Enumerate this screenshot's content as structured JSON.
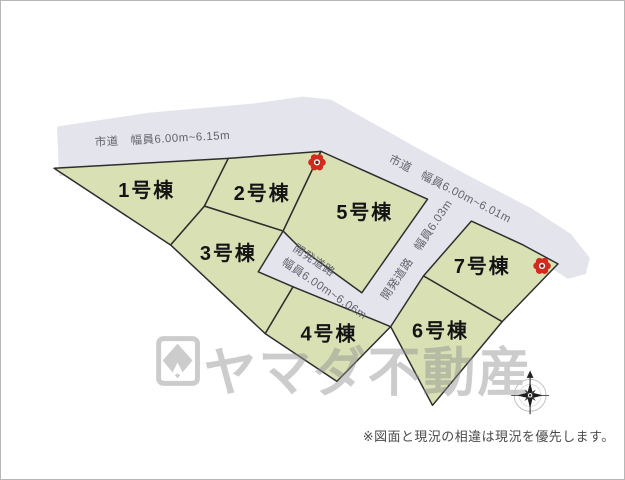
{
  "map": {
    "roads": {
      "shidou_top_label": "市道　幅員6.00m~6.15m",
      "shidou_right_label": "市道　幅員6.00m~6.01m",
      "kaihatsu_main_label_line1": "開発道路",
      "kaihatsu_main_label_line2": "幅員6.00m~6.06m",
      "kaihatsu_branch_label": "開発道路　幅員6.03m"
    },
    "plots": [
      {
        "label": "1号棟"
      },
      {
        "label": "2号棟"
      },
      {
        "label": "3号棟"
      },
      {
        "label": "4号棟"
      },
      {
        "label": "5号棟"
      },
      {
        "label": "6号棟"
      },
      {
        "label": "7号棟"
      }
    ],
    "icons": [
      "flower-marker",
      "flower-marker",
      "compass-rose-icon"
    ]
  },
  "watermark": {
    "logo": "yamada-logo-icon",
    "text": "ヤマダ不動産"
  },
  "footer": {
    "disclaimer": "※図面と現況の相違は現況を優先します。"
  },
  "colors": {
    "plot_fill": "#d8e0b4",
    "road_fill": "#e4e4ec",
    "outline": "#2e2e2e",
    "marker_red": "#d42a1e",
    "marker_center": "#8c1410"
  }
}
